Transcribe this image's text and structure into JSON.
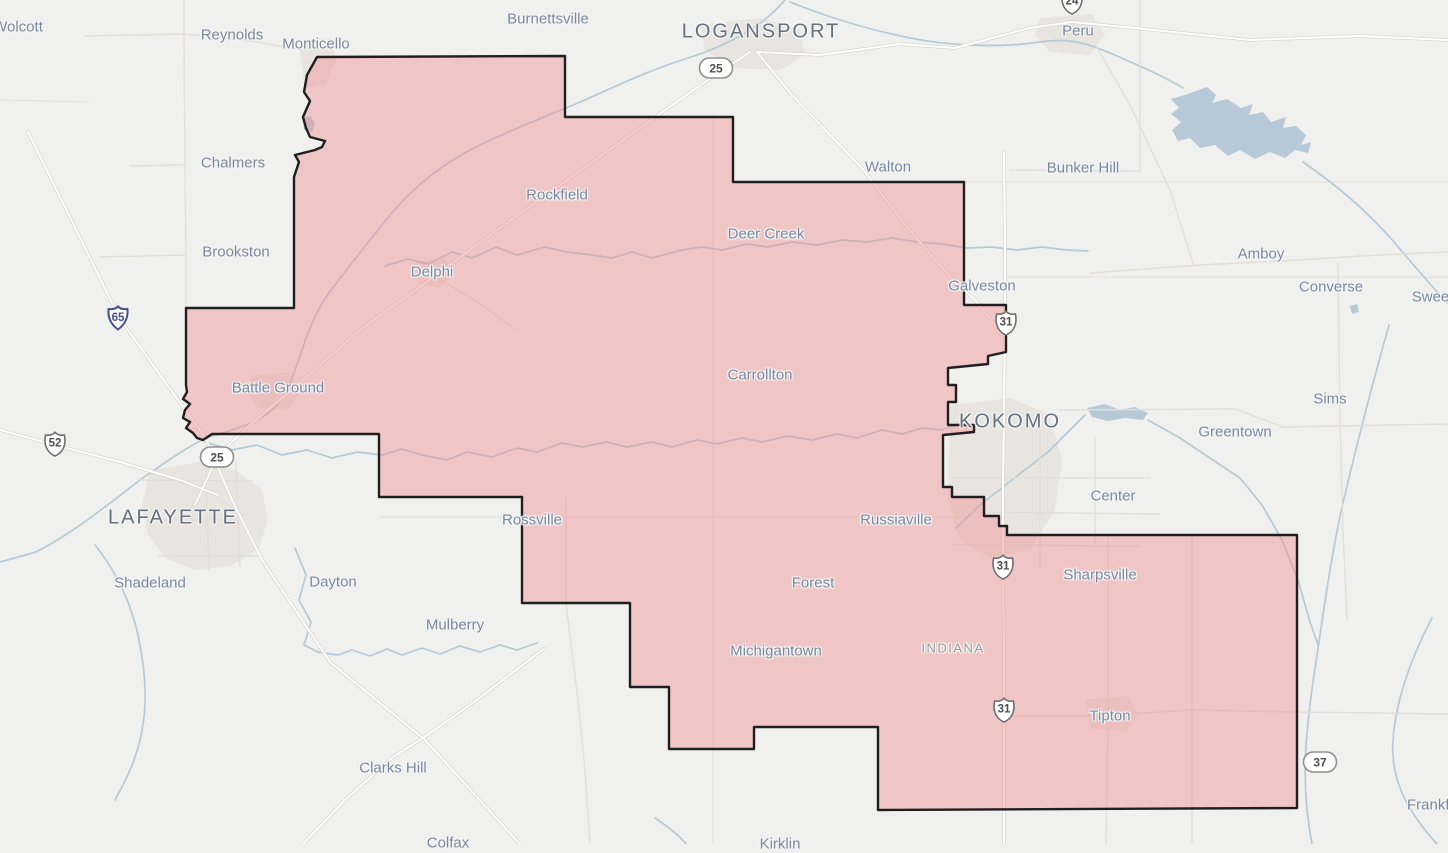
{
  "map": {
    "type": "road-map-with-highlighted-district",
    "state_label": "INDIANA",
    "colors": {
      "land": "#f0f0ee",
      "district_fill": "#f09092",
      "district_border": "#1f1f1f",
      "water": "#b7c9d6",
      "road": "#ffffff",
      "road_casing": "#d8d5cf",
      "road_minor": "#e2dfd9",
      "county_line": "#e3e0da",
      "urban": "#e8e5e0",
      "town_label": "#7b87a0",
      "city_label": "#66707e",
      "state_label_color": "#9b9b9b",
      "shield_text": "#4f4f4f",
      "interstate_accent": "#44518b"
    },
    "labels": [
      {
        "text": "Wolcott",
        "x": 18,
        "y": 27,
        "kind": "town"
      },
      {
        "text": "Reynolds",
        "x": 232,
        "y": 35,
        "kind": "town"
      },
      {
        "text": "Monticello",
        "x": 316,
        "y": 44,
        "kind": "town"
      },
      {
        "text": "Burnettsville",
        "x": 548,
        "y": 19,
        "kind": "town"
      },
      {
        "text": "LOGANSPORT",
        "x": 761,
        "y": 32,
        "kind": "city"
      },
      {
        "text": "Peru",
        "x": 1078,
        "y": 31,
        "kind": "town"
      },
      {
        "text": "Bunker Hill",
        "x": 1083,
        "y": 168,
        "kind": "town"
      },
      {
        "text": "Walton",
        "x": 888,
        "y": 167,
        "kind": "town"
      },
      {
        "text": "Amboy",
        "x": 1261,
        "y": 254,
        "kind": "town"
      },
      {
        "text": "Converse",
        "x": 1331,
        "y": 287,
        "kind": "town"
      },
      {
        "text": "Sweetser",
        "x": 1443,
        "y": 297,
        "kind": "town"
      },
      {
        "text": "Sims",
        "x": 1330,
        "y": 399,
        "kind": "town"
      },
      {
        "text": "Greentown",
        "x": 1235,
        "y": 432,
        "kind": "town"
      },
      {
        "text": "Center",
        "x": 1113,
        "y": 496,
        "kind": "town"
      },
      {
        "text": "Chalmers",
        "x": 233,
        "y": 163,
        "kind": "town"
      },
      {
        "text": "Brookston",
        "x": 236,
        "y": 252,
        "kind": "town"
      },
      {
        "text": "Delphi",
        "x": 432,
        "y": 272,
        "kind": "town"
      },
      {
        "text": "Rockfield",
        "x": 557,
        "y": 195,
        "kind": "town"
      },
      {
        "text": "Deer Creek",
        "x": 766,
        "y": 234,
        "kind": "town"
      },
      {
        "text": "Galveston",
        "x": 982,
        "y": 286,
        "kind": "town"
      },
      {
        "text": "Carrollton",
        "x": 760,
        "y": 375,
        "kind": "town"
      },
      {
        "text": "KOKOMO",
        "x": 1010,
        "y": 422,
        "kind": "city"
      },
      {
        "text": "Battle Ground",
        "x": 278,
        "y": 388,
        "kind": "town"
      },
      {
        "text": "LAFAYETTE",
        "x": 173,
        "y": 518,
        "kind": "city"
      },
      {
        "text": "Shadeland",
        "x": 150,
        "y": 583,
        "kind": "town"
      },
      {
        "text": "Dayton",
        "x": 333,
        "y": 582,
        "kind": "town"
      },
      {
        "text": "Mulberry",
        "x": 455,
        "y": 625,
        "kind": "town"
      },
      {
        "text": "Rossville",
        "x": 532,
        "y": 520,
        "kind": "town"
      },
      {
        "text": "Russiaville",
        "x": 896,
        "y": 520,
        "kind": "town"
      },
      {
        "text": "Forest",
        "x": 813,
        "y": 583,
        "kind": "town"
      },
      {
        "text": "Michigantown",
        "x": 776,
        "y": 651,
        "kind": "town"
      },
      {
        "text": "INDIANA",
        "x": 953,
        "y": 648,
        "kind": "state"
      },
      {
        "text": "Sharpsville",
        "x": 1100,
        "y": 575,
        "kind": "town"
      },
      {
        "text": "Tipton",
        "x": 1110,
        "y": 716,
        "kind": "town"
      },
      {
        "text": "Clarks Hill",
        "x": 393,
        "y": 768,
        "kind": "town"
      },
      {
        "text": "Colfax",
        "x": 448,
        "y": 843,
        "kind": "town"
      },
      {
        "text": "Kirklin",
        "x": 780,
        "y": 844,
        "kind": "town"
      },
      {
        "text": "Frankfort",
        "x": 1437,
        "y": 805,
        "kind": "town"
      }
    ],
    "shields": [
      {
        "kind": "interstate",
        "num": "65",
        "x": 118,
        "y": 318
      },
      {
        "kind": "us",
        "num": "52",
        "x": 55,
        "y": 444
      },
      {
        "kind": "pill",
        "num": "25",
        "x": 217,
        "y": 457
      },
      {
        "kind": "pill",
        "num": "25",
        "x": 716,
        "y": 68
      },
      {
        "kind": "us",
        "num": "24",
        "x": 1072,
        "y": 2
      },
      {
        "kind": "us",
        "num": "31",
        "x": 1006,
        "y": 323
      },
      {
        "kind": "us",
        "num": "31",
        "x": 1003,
        "y": 567
      },
      {
        "kind": "us",
        "num": "31",
        "x": 1004,
        "y": 710
      },
      {
        "kind": "pill",
        "num": "37",
        "x": 1320,
        "y": 762
      }
    ]
  }
}
